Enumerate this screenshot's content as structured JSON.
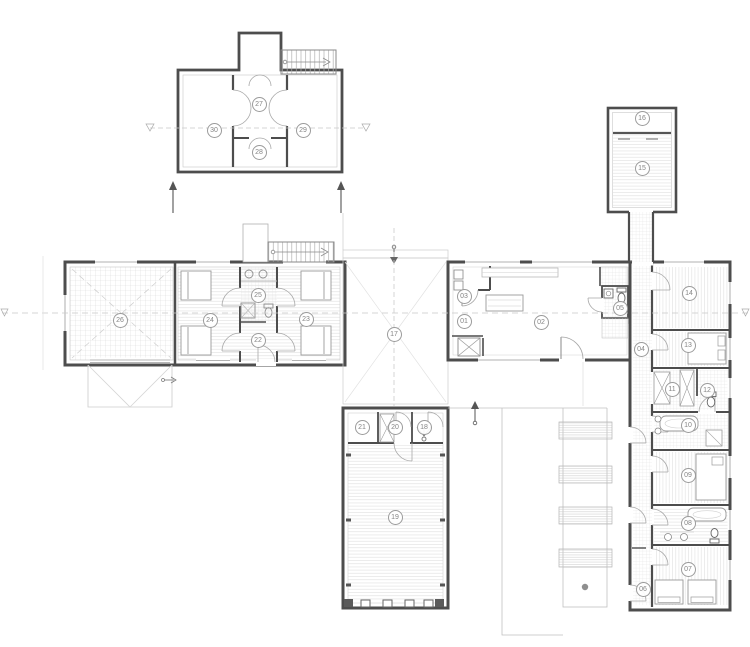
{
  "drawing": {
    "type": "architectural-floor-plan",
    "background": "#ffffff",
    "wall_color": "#4d4d4d",
    "fixture_color": "#9a9a9a",
    "hatch_color": "#dcdcdc",
    "centerline_color": "#c9c9c9",
    "label_border_color": "#9b9b9b",
    "label_text_color": "#858585"
  },
  "rooms": [
    {
      "id": "01",
      "x": 464,
      "y": 321
    },
    {
      "id": "02",
      "x": 541,
      "y": 322
    },
    {
      "id": "03",
      "x": 464,
      "y": 296
    },
    {
      "id": "04",
      "x": 641,
      "y": 349
    },
    {
      "id": "05",
      "x": 620,
      "y": 308
    },
    {
      "id": "06",
      "x": 643,
      "y": 589
    },
    {
      "id": "07",
      "x": 688,
      "y": 569
    },
    {
      "id": "08",
      "x": 688,
      "y": 523
    },
    {
      "id": "09",
      "x": 688,
      "y": 475
    },
    {
      "id": "10",
      "x": 688,
      "y": 425
    },
    {
      "id": "11",
      "x": 672,
      "y": 389
    },
    {
      "id": "12",
      "x": 707,
      "y": 390
    },
    {
      "id": "13",
      "x": 688,
      "y": 345
    },
    {
      "id": "14",
      "x": 689,
      "y": 293
    },
    {
      "id": "15",
      "x": 642,
      "y": 168
    },
    {
      "id": "16",
      "x": 642,
      "y": 118
    },
    {
      "id": "17",
      "x": 394,
      "y": 334
    },
    {
      "id": "18",
      "x": 424,
      "y": 427
    },
    {
      "id": "19",
      "x": 395,
      "y": 517
    },
    {
      "id": "20",
      "x": 395,
      "y": 427
    },
    {
      "id": "21",
      "x": 362,
      "y": 427
    },
    {
      "id": "22",
      "x": 258,
      "y": 340
    },
    {
      "id": "23",
      "x": 306,
      "y": 319
    },
    {
      "id": "24",
      "x": 210,
      "y": 320
    },
    {
      "id": "25",
      "x": 258,
      "y": 295
    },
    {
      "id": "26",
      "x": 120,
      "y": 320
    },
    {
      "id": "27",
      "x": 259,
      "y": 104
    },
    {
      "id": "28",
      "x": 259,
      "y": 152
    },
    {
      "id": "29",
      "x": 303,
      "y": 130
    },
    {
      "id": "30",
      "x": 214,
      "y": 130
    }
  ]
}
